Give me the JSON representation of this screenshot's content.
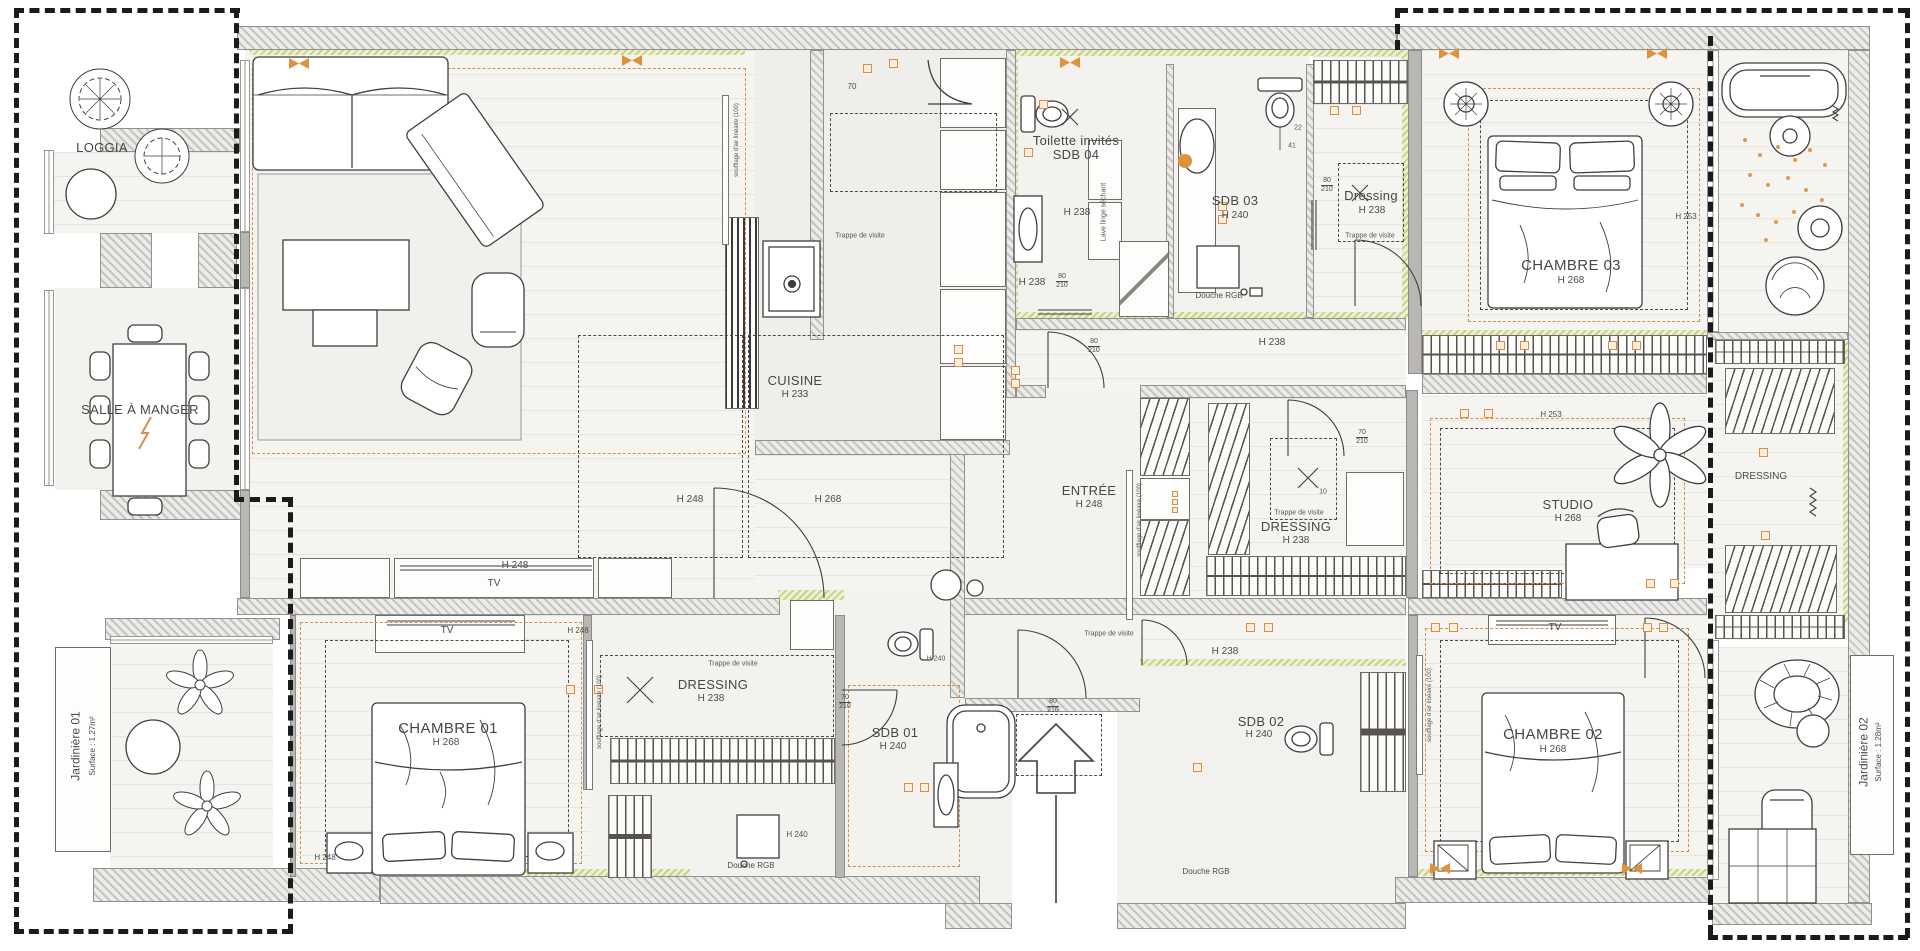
{
  "meta": {
    "type": "architectural-floor-plan",
    "colors": {
      "accent_orange": "#d3904a",
      "marker_orange": "#e0913c",
      "wall_hatch": "#c6c4c0",
      "khaki_insulation": "#ccd68b",
      "floor_light": "#f5f4f1",
      "boundary_black": "#1b1b1b",
      "line": "#3f3f3f"
    }
  },
  "rooms": {
    "loggia": {
      "label": "LOGGIA"
    },
    "salle_a_manger": {
      "label": "SALLE À MANGER"
    },
    "cuisine": {
      "label": "CUISINE",
      "height": "H 233"
    },
    "sdb04": {
      "label_line1": "Toilette invités",
      "label_line2": "SDB 04",
      "height": "H 238"
    },
    "sdb03": {
      "label": "SDB 03",
      "height": "H 240",
      "note": "Douche RGB"
    },
    "dressing_haut": {
      "label": "Dressing",
      "height": "H 238"
    },
    "chambre03": {
      "label": "CHAMBRE 03",
      "height": "H 268",
      "ceiling": "H 253"
    },
    "couloir_haut": {
      "height": "H 238"
    },
    "entree": {
      "label": "ENTRÉE",
      "height": "H 248"
    },
    "dressing_centre": {
      "label": "DRESSING",
      "height": "H 238"
    },
    "couloir_bas": {
      "height": "H 238"
    },
    "studio": {
      "label": "STUDIO",
      "height": "H 268",
      "ceiling": "H 253"
    },
    "dressing_droit": {
      "label": "DRESSING"
    },
    "chambre01": {
      "label": "CHAMBRE 01",
      "height": "H 268"
    },
    "dressing_ch01": {
      "label": "DRESSING",
      "height": "H 238"
    },
    "sdb01": {
      "label": "SDB 01",
      "height": "H 240",
      "note": "Douche RGB",
      "shower_height": "H 240",
      "wc_height": "H 240"
    },
    "sdb02": {
      "label": "SDB 02",
      "height": "H 240",
      "note": "Douche RGB"
    },
    "chambre02": {
      "label": "CHAMBRE 02",
      "height": "H 268"
    },
    "jardiniere01": {
      "label": "Jardinière 01",
      "surface": "Surface : 1.27m²"
    },
    "jardiniere02": {
      "label": "Jardinière 02",
      "surface": "Surface : 1.28m²"
    }
  },
  "annotations": {
    "trappe": "Trappe de visite",
    "tv": "TV",
    "lave_linge": "Lave linge séchant",
    "soufflage": "soufflage d'air linéaire (100)",
    "h248": "H 248",
    "h268": "H 268",
    "h240": "H 240",
    "h238": "H 238",
    "h253": "H 253"
  },
  "dimensions": {
    "d70": "70",
    "d80": "80",
    "d210": "210",
    "d22": "22",
    "d41": "41",
    "d10": "10"
  }
}
